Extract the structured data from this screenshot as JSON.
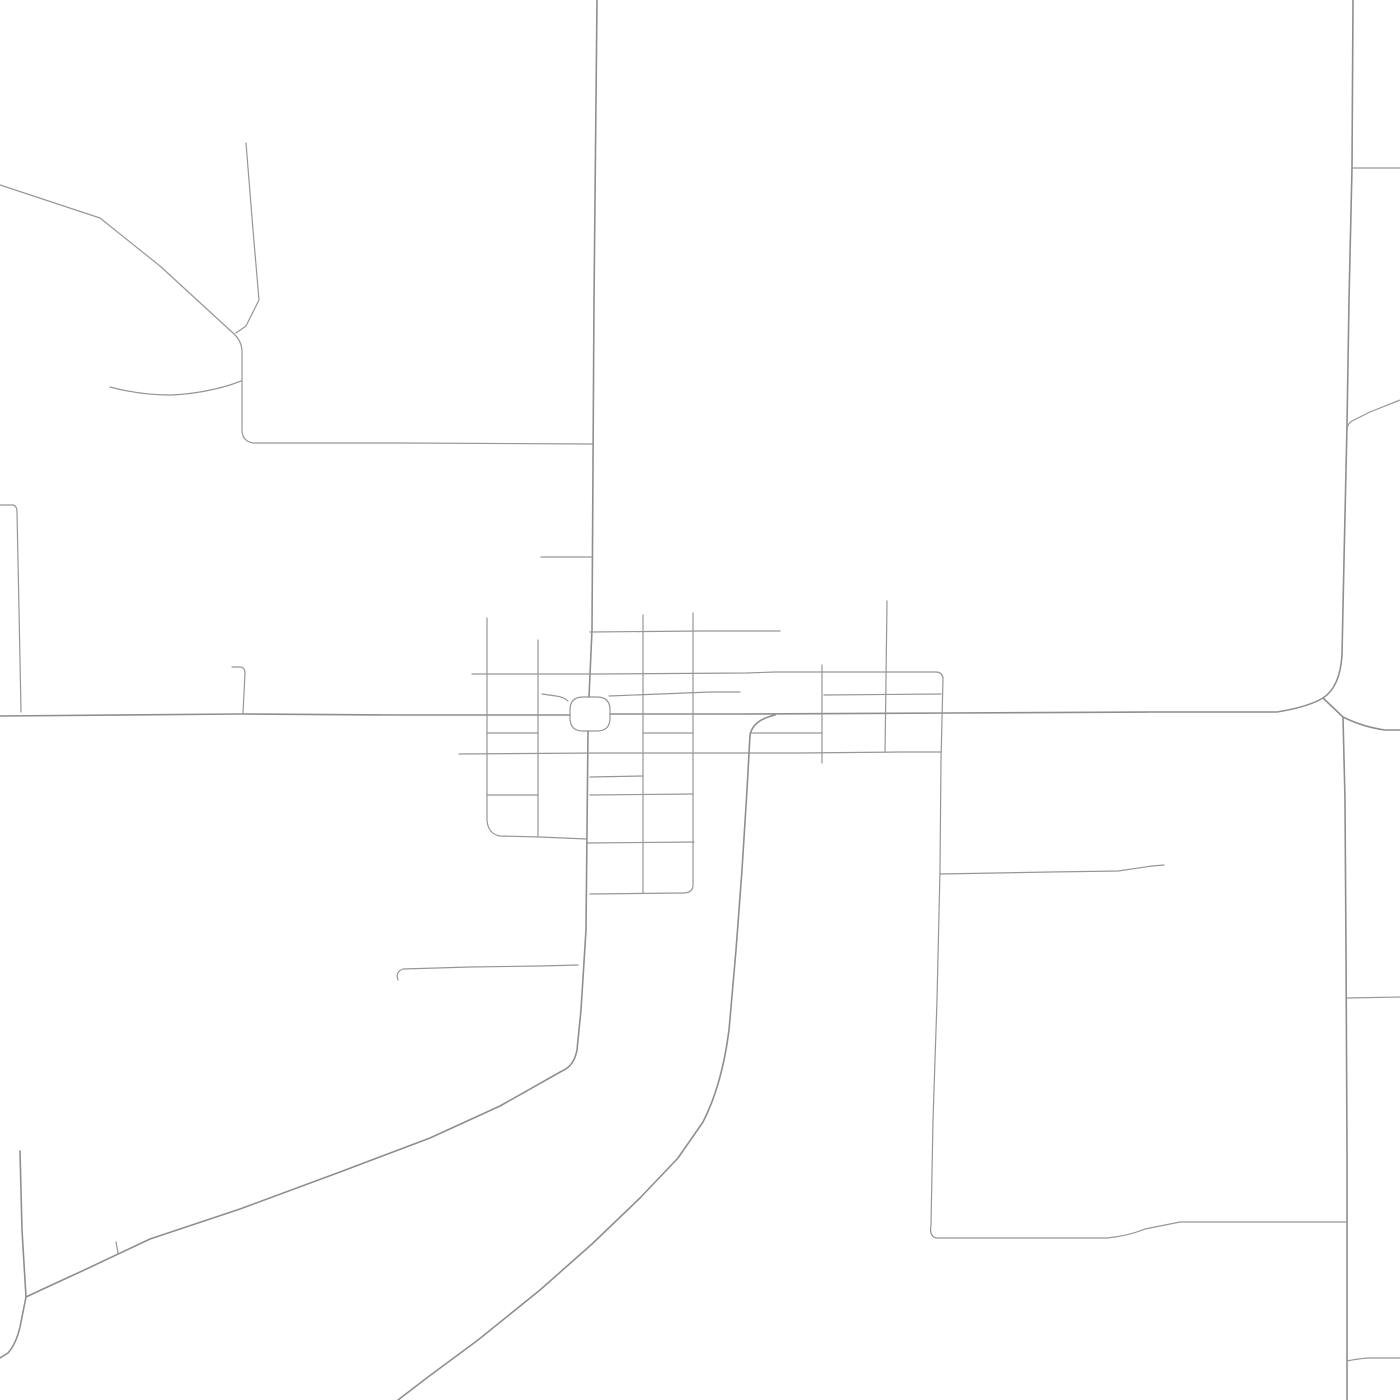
{
  "map": {
    "background": "#ffffff",
    "road_color": "#969696",
    "major_road_color": "#8e8e8e",
    "major_width": 1.6,
    "minor_width": 1.2,
    "canvas": {
      "width": 1400,
      "height": 1400
    },
    "town_square_loop": {
      "id": "town-square-loop",
      "d": "M 583,697 L 597,697 Q 610,697 610,710 L 610,718 Q 610,731 597,731 L 583,731 Q 570,731 570,718 L 570,710 Q 570,697 583,697 Z"
    },
    "roads": [
      {
        "id": "highway-west",
        "class": "major",
        "d": "M 0,716 L 240,714 400,715 470,715 570,715"
      },
      {
        "id": "highway-mid",
        "class": "major",
        "d": "M 610,714 L 740,714 950,713 1150,712 1277,712 Q 1308,707 1323,698"
      },
      {
        "id": "highway-east",
        "class": "major",
        "d": "M 1343,717 Q 1363,727 1385,730 L 1400,730"
      },
      {
        "id": "junction-connector",
        "class": "major",
        "d": "M 1323,698 L 1343,717"
      },
      {
        "id": "route-north",
        "class": "major",
        "d": "M 1353,0 L 1352,168 1349,300 1347,425 1344,560 1342,655 Q 1340,687 1323,698"
      },
      {
        "id": "route-south",
        "class": "major",
        "d": "M 1343,717 L 1345,800 1346,950 1347,1150 1347,1400"
      },
      {
        "id": "main-street-north",
        "class": "major",
        "d": "M 597,0 L 594,300 592,630 589,697"
      },
      {
        "id": "main-street-south",
        "class": "major",
        "d": "M 588,731 L 586,930 581,1010 577,1050 Q 574,1066 562,1071 L 500,1106 430,1138 340,1172 240,1209 150,1239 80,1272 Q 45,1288 26,1297"
      },
      {
        "id": "west-vertical-bottom",
        "class": "major",
        "d": "M 20,1151 L 22,1230 26,1297 L 20,1327 Q 16,1344 8,1353 L 0,1358"
      },
      {
        "id": "big-curve-south",
        "class": "major",
        "d": "M 775,715 Q 753,720 750,735 L 747,790 742,870 736,950 729,1030 Q 722,1085 703,1122 L 678,1158 640,1198 592,1244 540,1290 478,1340 428,1377 L 398,1400"
      },
      {
        "id": "nw-diagonal",
        "class": "minor",
        "d": "M 0,185 L 100,218 160,266 233,333 Q 242,341 242,352 L 242,430 Q 242,441 253,443 L 400,443 592,444"
      },
      {
        "id": "nw-branch-vertical",
        "class": "minor",
        "d": "M 246,143 L 253,230 259,300 L 246,326 236,333"
      },
      {
        "id": "nw-wavy-branch",
        "class": "minor",
        "d": "M 110,387 Q 140,395 170,395 Q 200,394 230,385 L 241,381"
      },
      {
        "id": "west-stub",
        "class": "minor",
        "d": "M 0,505 L 13,505 Q 17,506 17,512 L 19,610 21,712"
      },
      {
        "id": "north-stub-557",
        "class": "minor",
        "d": "M 541,557 L 592,557"
      },
      {
        "id": "stub-232",
        "class": "minor",
        "d": "M 232,667 L 241,667 Q 245,668 245,673 L 243,713"
      },
      {
        "id": "street-630",
        "class": "minor",
        "d": "M 590,632 L 700,631 780,631"
      },
      {
        "id": "street-673-long",
        "class": "minor",
        "d": "M 472,674 L 600,674 746,673 L 775,672 880,672 936,672 Q 942,672 943,678 L 941,760 940,870 937,1000 933,1120 931,1225 Q 929,1236 936,1238 L 1000,1238 1107,1238 Q 1128,1236 1145,1229 L 1180,1222 1280,1222 1347,1222"
      },
      {
        "id": "street-694-west",
        "class": "minor",
        "d": "M 542,694 L 556,696 Q 564,697 568,701"
      },
      {
        "id": "street-694-east",
        "class": "minor",
        "d": "M 609,696 L 660,694 710,692 740,692"
      },
      {
        "id": "street-753-long",
        "class": "minor",
        "d": "M 459,754 L 600,753 700,753 800,753 900,752 941,752"
      },
      {
        "id": "block-right-695",
        "class": "minor",
        "d": "M 824,695 L 941,694"
      },
      {
        "id": "vertical-822",
        "class": "minor",
        "d": "M 822,665 L 822,733 822,763"
      },
      {
        "id": "vertical-886",
        "class": "minor",
        "d": "M 887,601 L 886,680 885,752"
      },
      {
        "id": "street-733-right",
        "class": "minor",
        "d": "M 750,733 L 822,733"
      },
      {
        "id": "vertical-487",
        "class": "minor",
        "d": "M 487,618 L 487,733 487,820 Q 488,834 500,836 L 540,837 587,839"
      },
      {
        "id": "vertical-538",
        "class": "minor",
        "d": "M 538,640 L 538,753 538,837"
      },
      {
        "id": "street-733-left",
        "class": "minor",
        "d": "M 487,733 L 538,733"
      },
      {
        "id": "street-795-left",
        "class": "minor",
        "d": "M 487,795 L 538,795"
      },
      {
        "id": "vertical-643",
        "class": "minor",
        "d": "M 643,615 L 643,753 643,893"
      },
      {
        "id": "vertical-693",
        "class": "minor",
        "d": "M 693,613 L 693,753 693,800 693,885 Q 693,893 683,893 L 590,894"
      },
      {
        "id": "street-733-mid",
        "class": "minor",
        "d": "M 643,733 L 693,733"
      },
      {
        "id": "street-777",
        "class": "minor",
        "d": "M 590,777 L 643,776"
      },
      {
        "id": "street-795-mid",
        "class": "minor",
        "d": "M 590,795 L 693,794"
      },
      {
        "id": "street-843",
        "class": "minor",
        "d": "M 587,843 L 694,842"
      },
      {
        "id": "street-966",
        "class": "minor",
        "d": "M 398,980 Q 395,972 403,969 L 470,967 540,966 578,965"
      },
      {
        "id": "street-872",
        "class": "minor",
        "d": "M 940,874 L 1050,872 1118,871 Q 1138,868 1152,866 L 1164,865"
      },
      {
        "id": "ne-diagonal",
        "class": "minor",
        "d": "M 1400,400 L 1370,412 1352,421 Q 1348,423 1347,429"
      },
      {
        "id": "ne-stub-168",
        "class": "minor",
        "d": "M 1352,168 L 1400,168"
      },
      {
        "id": "east-branch-998",
        "class": "minor",
        "d": "M 1347,998 L 1400,997"
      },
      {
        "id": "east-branch-1358",
        "class": "minor",
        "d": "M 1347,1361 Q 1356,1359 1368,1358 L 1400,1358"
      },
      {
        "id": "tick-1247",
        "class": "minor",
        "d": "M 116,1242 L 118,1253"
      }
    ]
  }
}
